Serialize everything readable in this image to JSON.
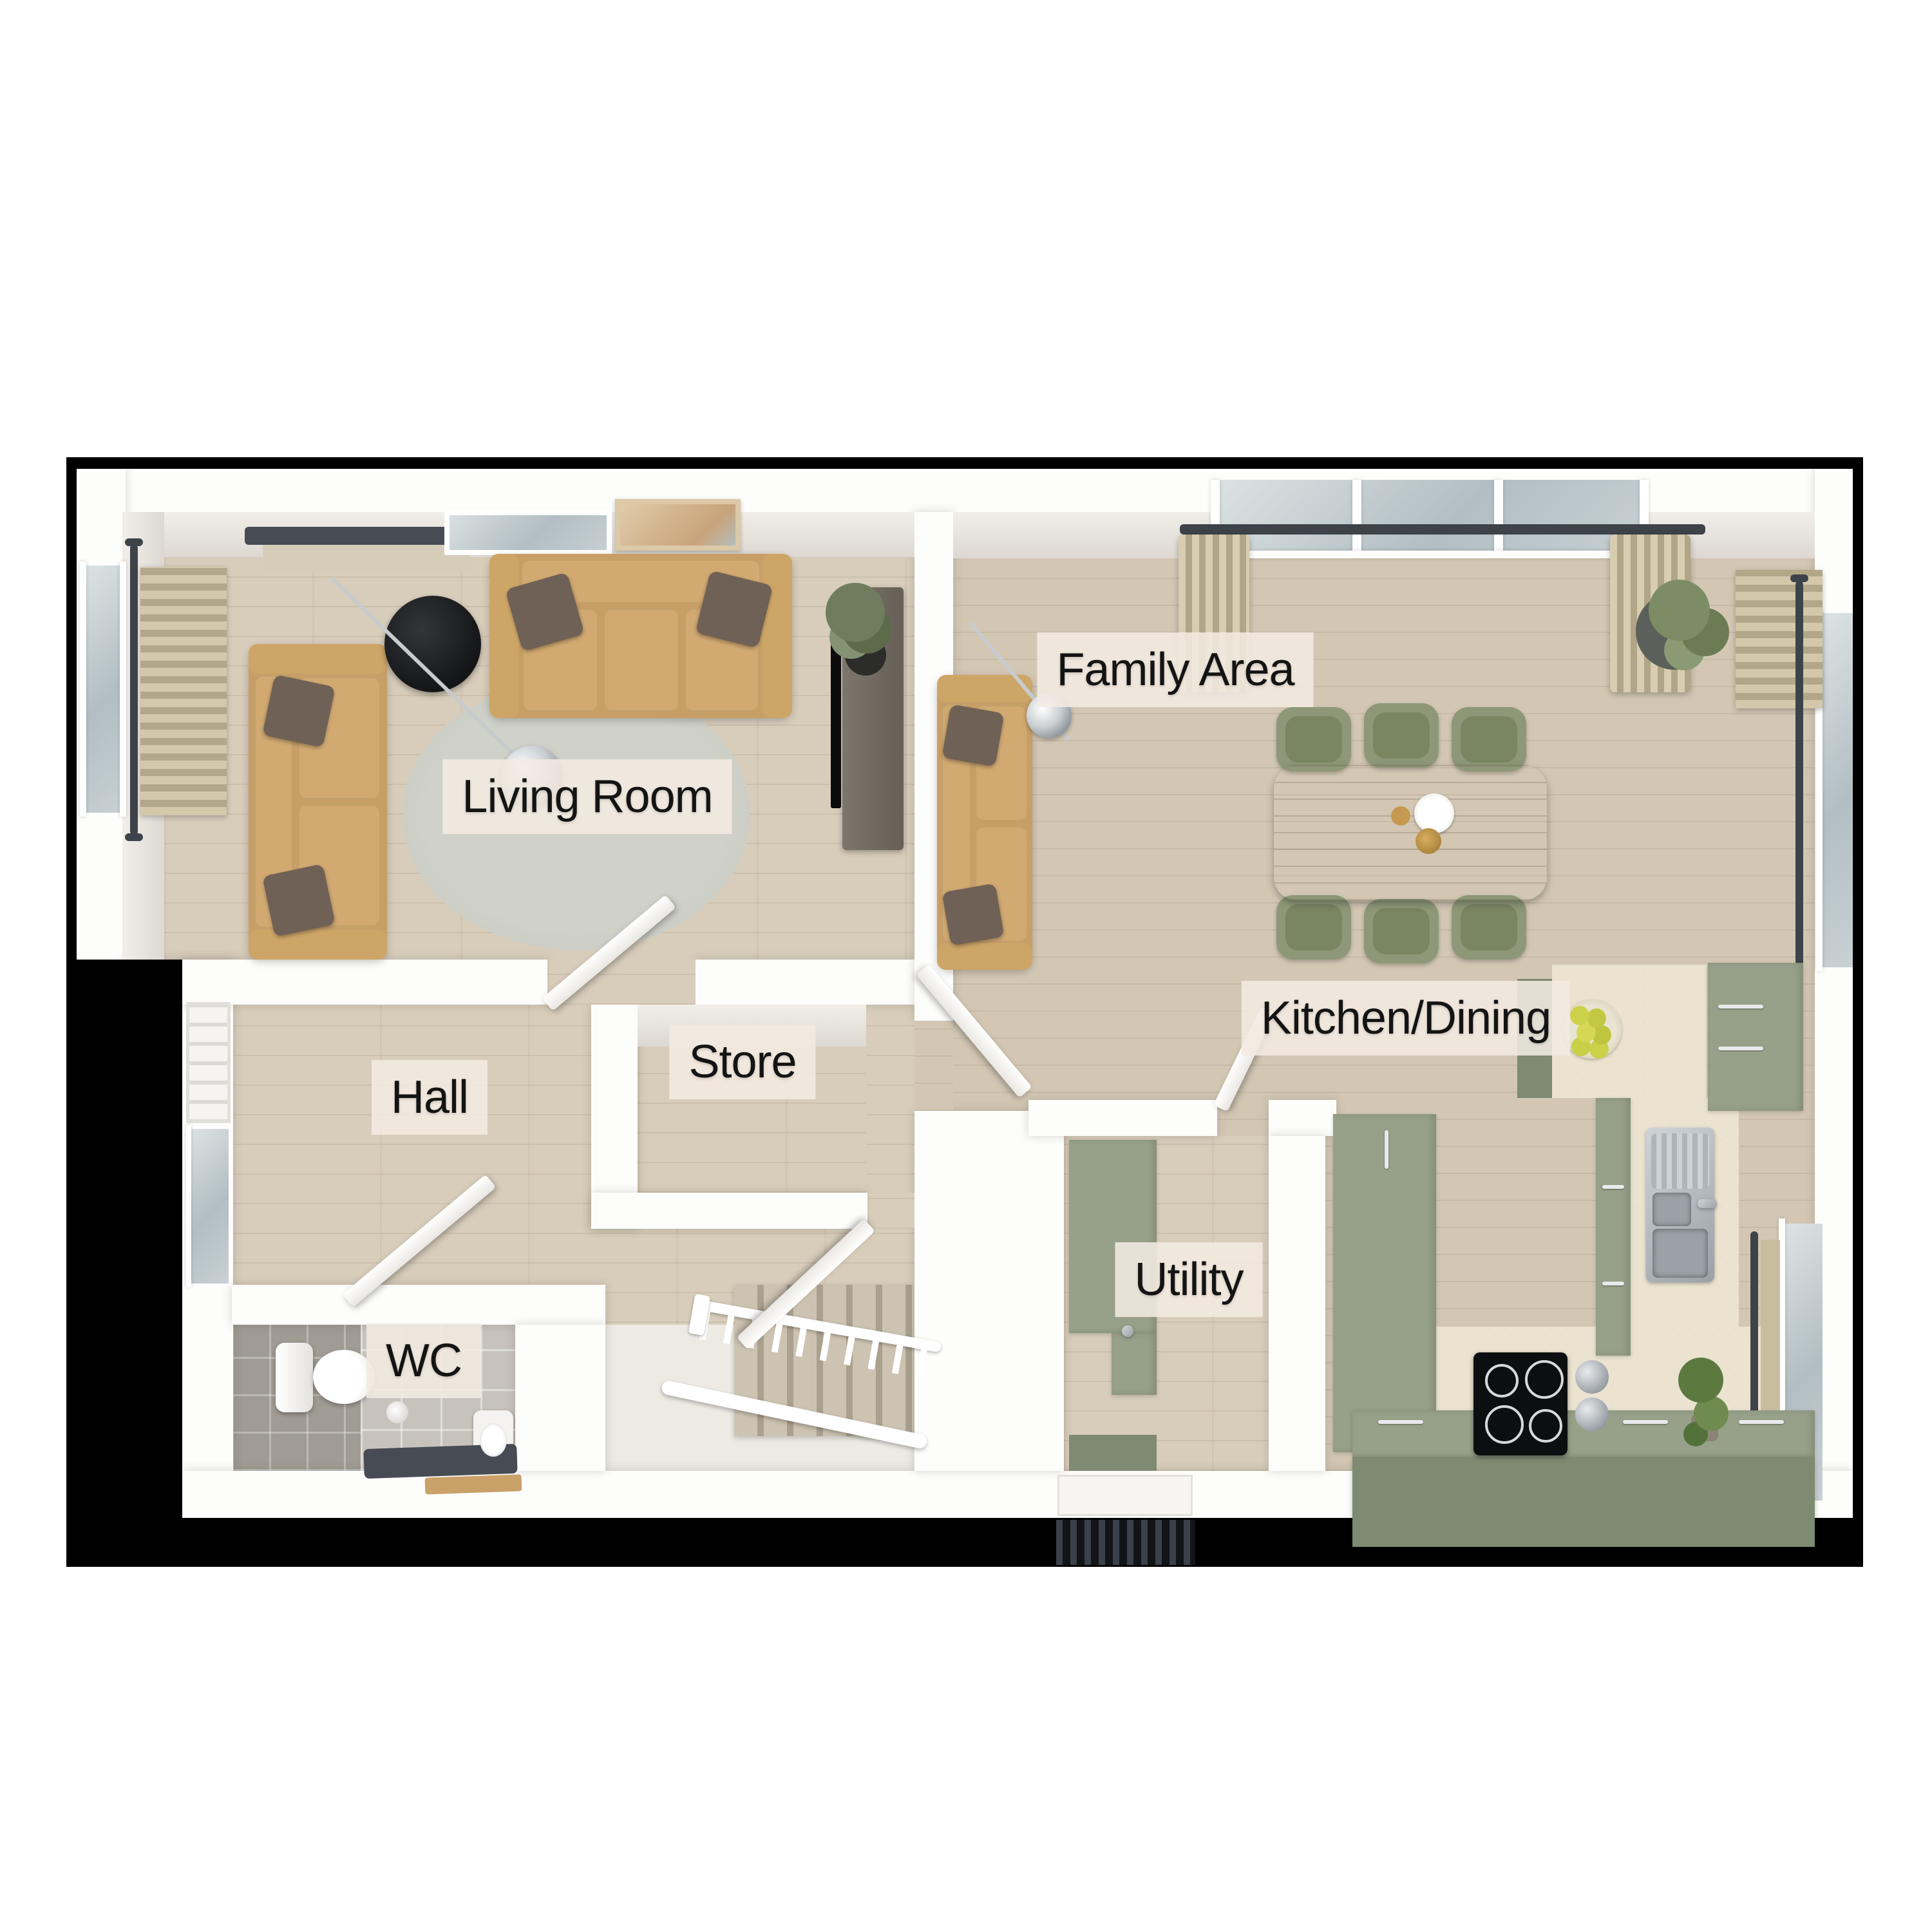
{
  "rooms": [
    {
      "id": "living-room",
      "label": "Living Room"
    },
    {
      "id": "family-area",
      "label": "Family Area"
    },
    {
      "id": "kitchen-dining",
      "label": "Kitchen/Dining"
    },
    {
      "id": "hall",
      "label": "Hall"
    },
    {
      "id": "store",
      "label": "Store"
    },
    {
      "id": "wc",
      "label": "WC"
    },
    {
      "id": "utility",
      "label": "Utility"
    }
  ],
  "colors": {
    "outline_black": "#000000",
    "wall_white": "#fdfdfc",
    "wood_floor": "#d8cdbb",
    "worktop_cream": "#ebe3d0",
    "cabinet_sage_green": "#97a189",
    "cabinet_sage_dark": "#7e8a71",
    "sofa_tan": "#c79f66",
    "pillow_brown": "#6f6156",
    "chair_olive": "#8e9878",
    "table_walnut": "#7d5f47",
    "wc_tile_grey": "#a09b93",
    "rug_grey": "#cbcdc5",
    "label_background": "#f3ebe1",
    "label_text": "#141414"
  }
}
